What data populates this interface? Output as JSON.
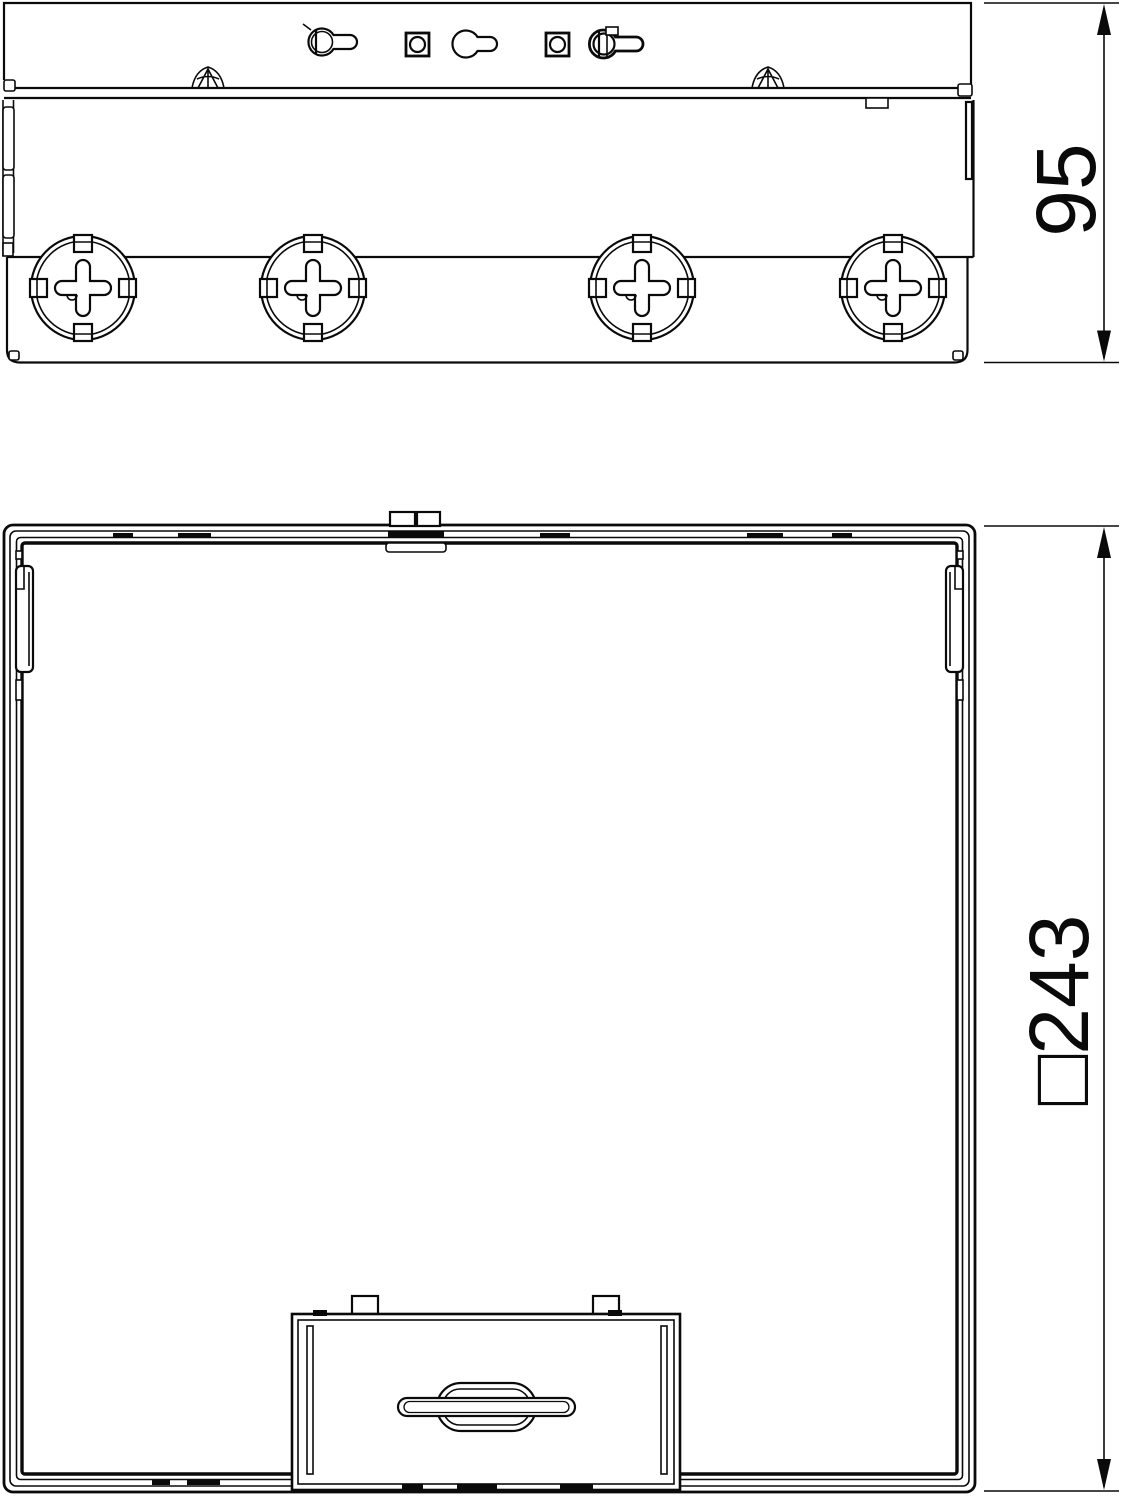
{
  "drawing": {
    "kind": "technical-dimension-drawing",
    "background": "#ffffff",
    "line_color": "#0a0a0a",
    "views": {
      "side": {
        "name": "side-elevation",
        "dimension": {
          "label": "95"
        }
      },
      "plan": {
        "name": "plan-view",
        "dimension": {
          "label": "□243"
        }
      }
    }
  }
}
